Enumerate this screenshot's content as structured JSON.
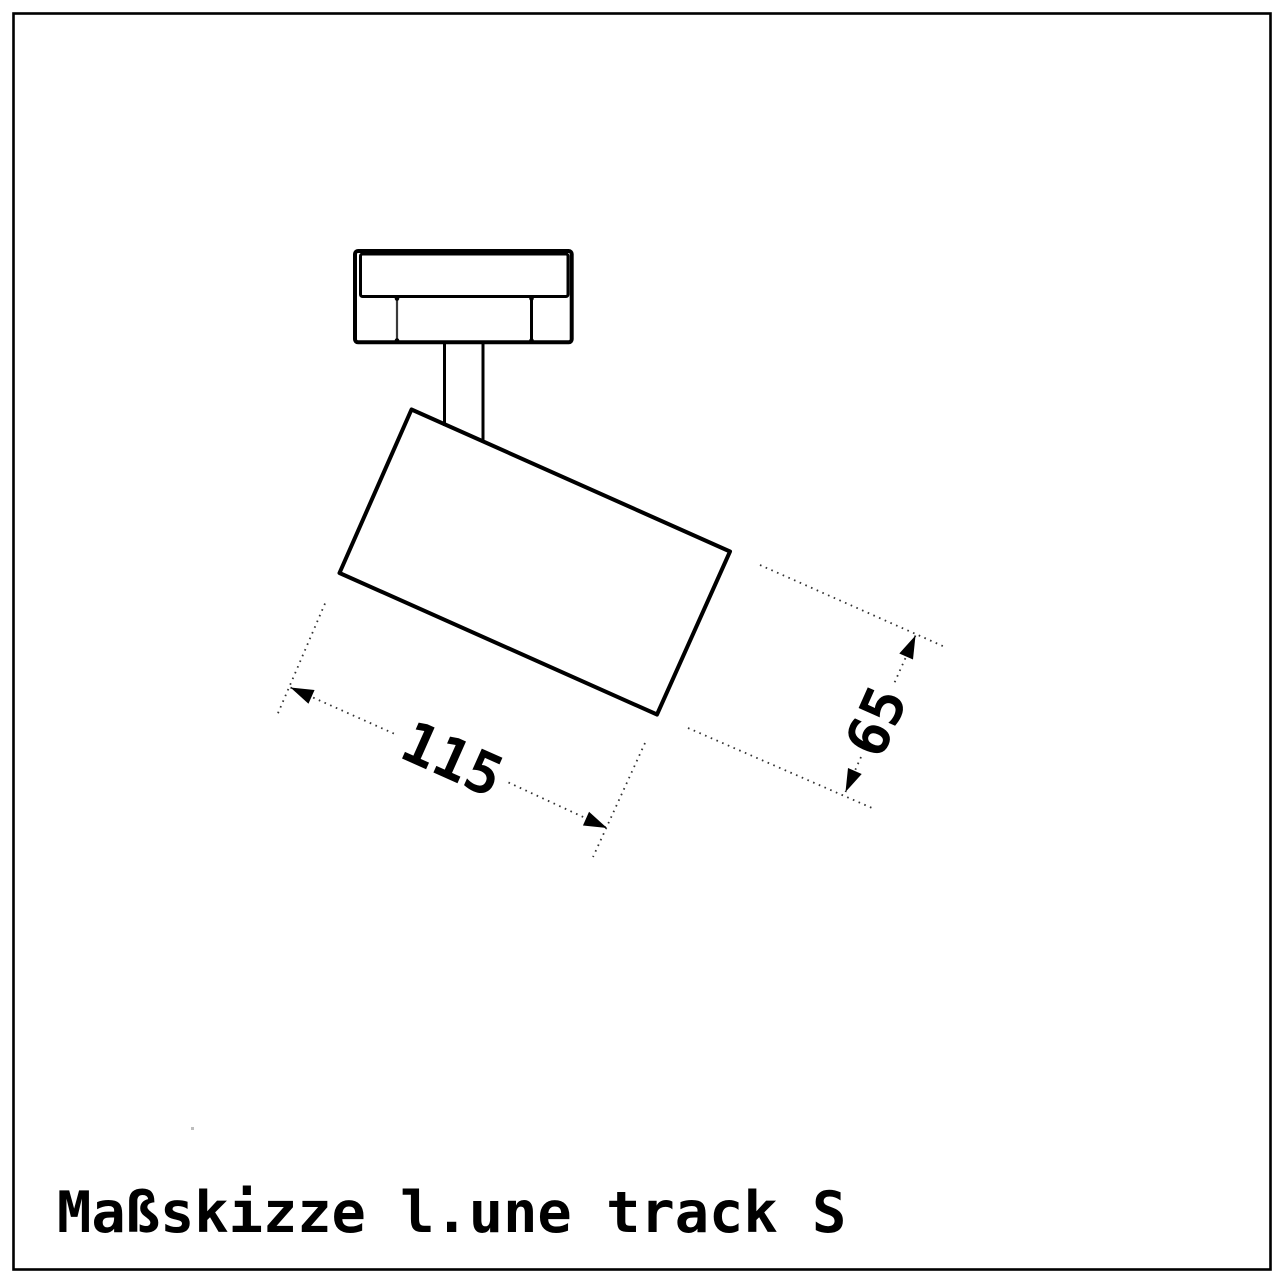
{
  "page": {
    "background": "#ffffff",
    "line_color": "#000000",
    "dash_color": "#333333"
  },
  "drawing": {
    "caption": "Maßskizze l.une track S",
    "dimensions": {
      "length_label": "115",
      "height_label": "65"
    }
  }
}
